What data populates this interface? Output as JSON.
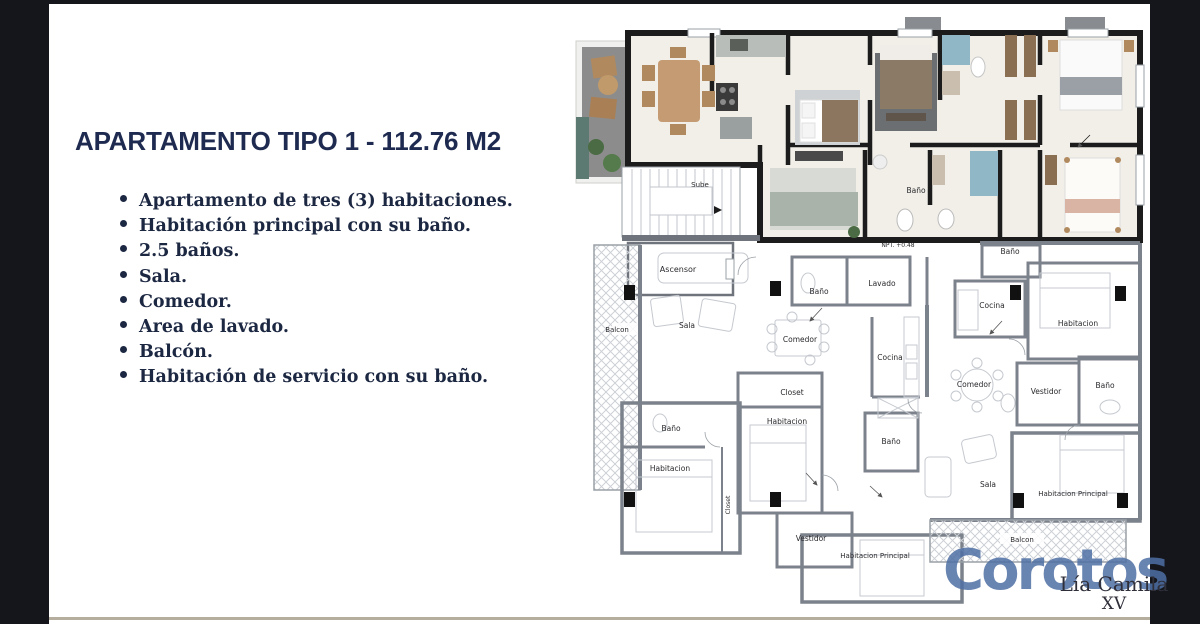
{
  "colors": {
    "background": "#14161c",
    "panel": "#ffffff",
    "title_navy": "#1e2a4f",
    "body_navy": "#1c2742",
    "brand_blue": "#4d6ea3",
    "render_wall": "#1c1c1c",
    "plan_wall_gray": "#7c828c",
    "bath_teal": "#8fb7c6"
  },
  "left_panel": {
    "title": "APARTAMENTO TIPO 1 - 112.76 M2",
    "bullets": [
      "Apartamento de tres (3) habitaciones.",
      "Habitación principal con su baño.",
      "2.5 baños.",
      "Sala.",
      "Comedor.",
      "Area de lavado.",
      "Balcón.",
      "Habitación de servicio con su baño."
    ]
  },
  "floorplan": {
    "labels": {
      "sube": "Sube",
      "ascensor": "Ascensor",
      "balcon_izq": "Balcon",
      "sala_izq": "Sala",
      "bano_pasillo": "Baño",
      "lavado": "Lavado",
      "comedor_izq": "Comedor",
      "cocina_izq": "Cocina",
      "closet_izq": "Closet",
      "habitacion_centro": "Habitacion",
      "bano_servicio": "Baño",
      "habitacion_servicio": "Habitacion",
      "closet_vertical": "Closet",
      "bano_centro": "Baño",
      "vestidor_izq": "Vestidor",
      "habitacion_principal_izq": "Habitacion Principal",
      "bano_der_sup": "Baño",
      "cocina_der": "Cocina",
      "habitacion_der": "Habitacion",
      "comedor_der": "Comedor",
      "vestidor_der": "Vestidor",
      "bano_der": "Baño",
      "sala_der": "Sala",
      "habitacion_principal_der": "Habitacion Principal",
      "balcon_inferior": "Balcon",
      "bano_render": "Baño",
      "npt": "NPT. +0.48"
    }
  },
  "watermark": {
    "brand": "Corotos",
    "vendor_name": "Lía Camila",
    "vendor_suffix": "XV"
  }
}
